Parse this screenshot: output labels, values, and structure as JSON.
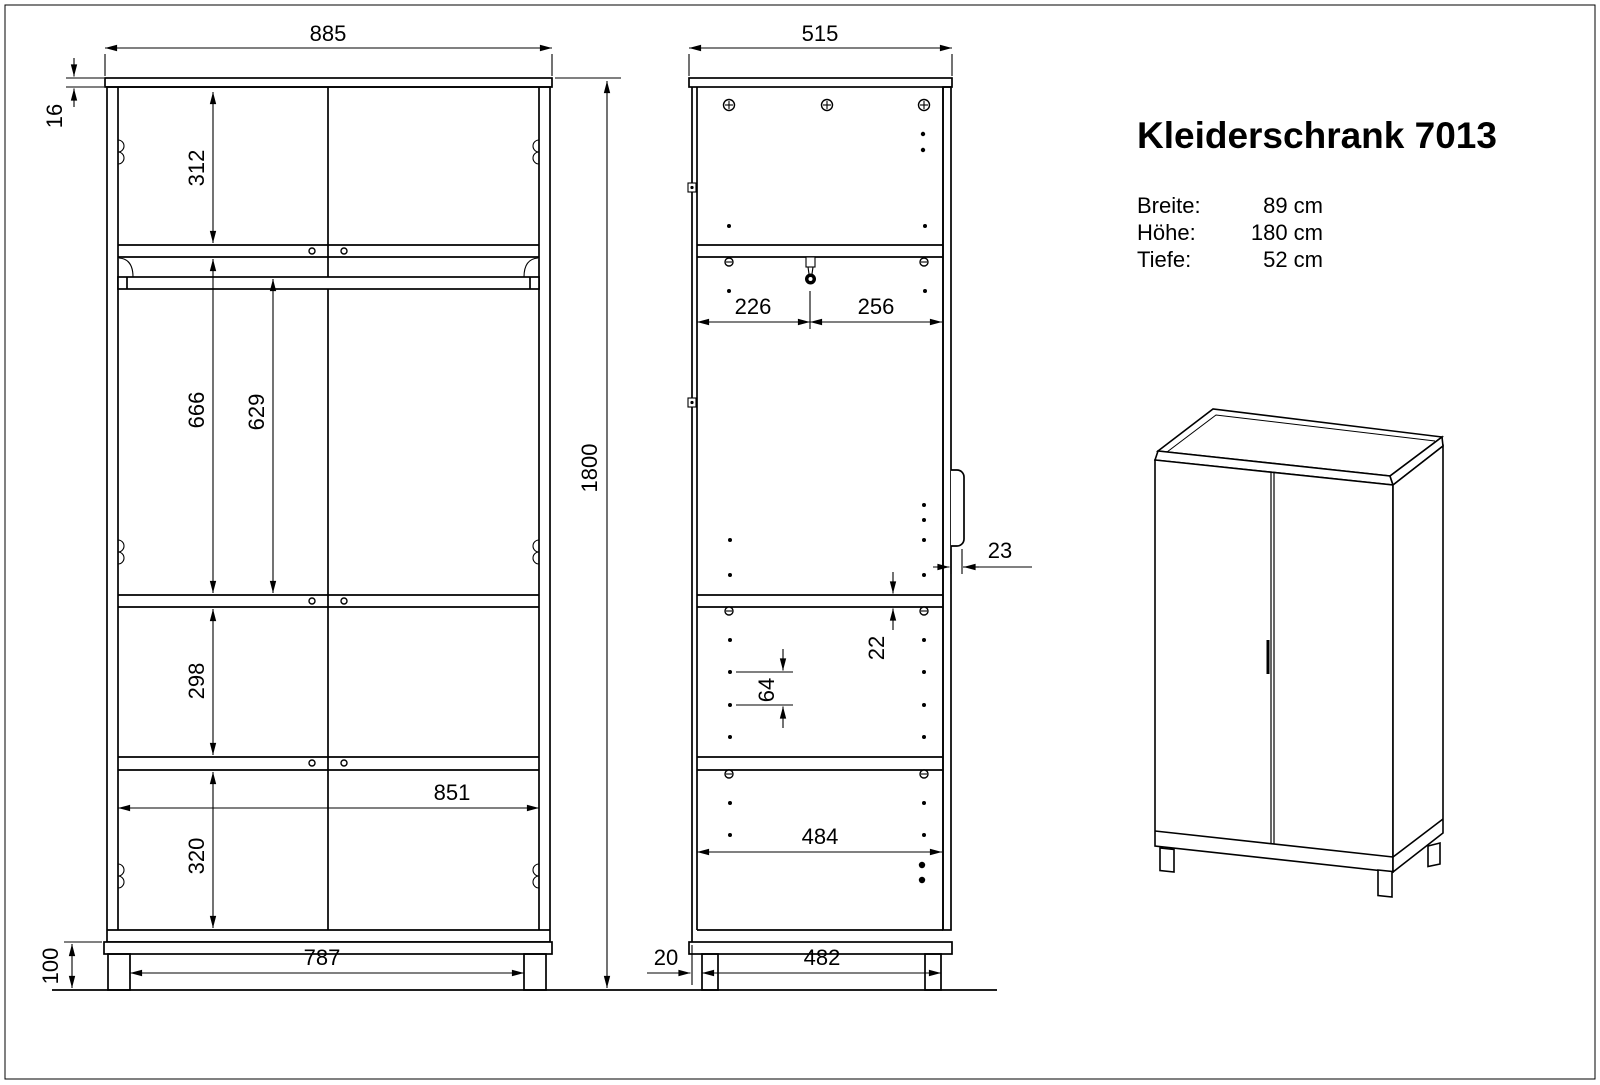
{
  "title_block": {
    "title": "Kleiderschrank 7013",
    "specs": [
      {
        "label": "Breite:",
        "value": "89 cm"
      },
      {
        "label": "Höhe:",
        "value": "180 cm"
      },
      {
        "label": "Tiefe:",
        "value": "52 cm"
      }
    ]
  },
  "colors": {
    "line": "#000000",
    "background": "#ffffff"
  },
  "front_view": {
    "dims": {
      "overall_width": "885",
      "top_thickness": "16",
      "overall_height": "1800",
      "section_top": "312",
      "section_hang": "666",
      "rod_to_shelf": "629",
      "section_middle": "298",
      "section_bottom": "320",
      "inner_width": "851",
      "plinth_height": "100",
      "leg_span": "787"
    }
  },
  "side_view": {
    "dims": {
      "overall_depth": "515",
      "rod_front": "226",
      "rod_back": "256",
      "handle_projection": "23",
      "shelf_thickness": "22",
      "hole_pitch": "64",
      "inner_depth": "484",
      "leg_setback": "20",
      "leg_span": "482"
    }
  }
}
